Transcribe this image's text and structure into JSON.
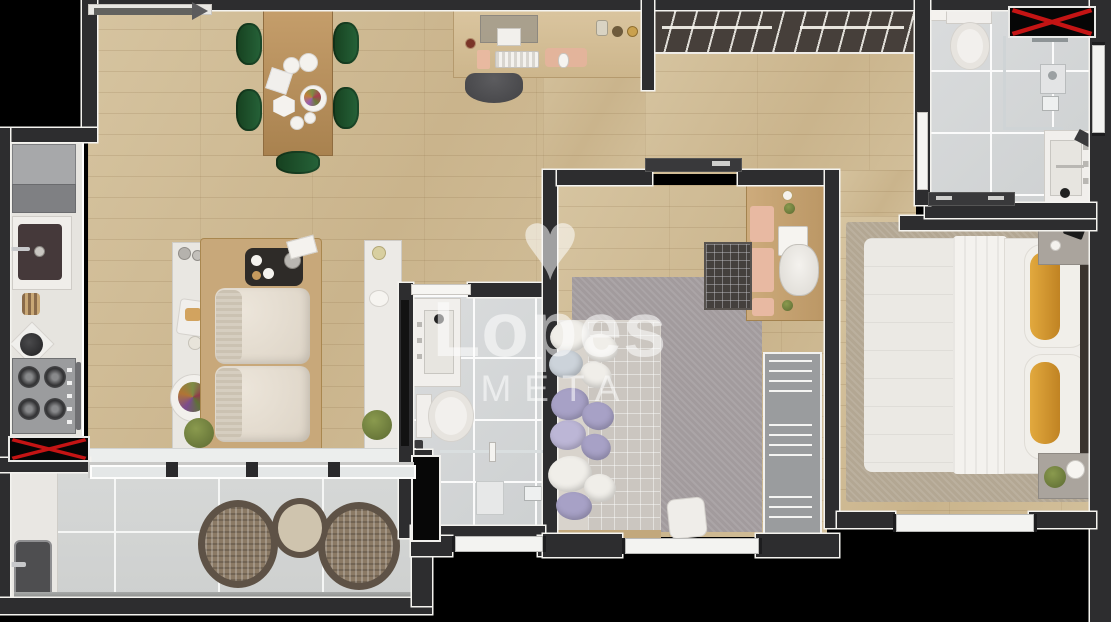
{
  "watermark": {
    "brand": "Lopes",
    "division": "META",
    "logo_glyph": "♥",
    "text_color": "#ffffff"
  },
  "palette": {
    "outside": "#000000",
    "wall": "#2d2d2f",
    "wall_trim": "#f4f3ef",
    "wood_floor": "#cfbb95",
    "bath_tile": "#d6d8d9",
    "balcony_tile": "#d2d4d3",
    "counter_white": "#e9e7e2",
    "rug_gray": "#a29b9d",
    "rug_beige": "#b3a793",
    "bedding": "#ebe9e4",
    "quilt": "#cbc6c0",
    "pillow_lavender": "#a7a1c6",
    "pillow_orange": "#d9952b",
    "dining_chair_green": "#1b4726",
    "furniture_wood": "#c29c6b",
    "closet": "#463f3a",
    "appliance_gray": "#9b9c9e",
    "shaft_black": "#060606",
    "cross_red": "#c41414",
    "plant_green": "#76853f"
  },
  "markers": {
    "crossed_shaft_count": 2
  },
  "rooms": {
    "living_dining": {
      "furniture": [
        "dining-table",
        "dining-chair x5",
        "sofa",
        "side-island",
        "serving-tray",
        "tv-console",
        "tv",
        "floor-plant"
      ]
    },
    "office_nook": {
      "furniture": [
        "desk",
        "monitor",
        "keyboard",
        "mouse-pad",
        "desk-chair"
      ]
    },
    "kitchen": {
      "furniture": [
        "fridge",
        "sink",
        "utensil-crock",
        "kettle",
        "gas-stove",
        "oven-handle"
      ]
    },
    "hall_closet": {
      "furniture": [
        "open-wardrobe-hanger-rail"
      ]
    },
    "bathroom_top_right": {
      "furniture": [
        "toilet",
        "shower-glass",
        "shower-column",
        "floor-drain",
        "vanity-sink",
        "sliding-door",
        "door-leaf",
        "window"
      ]
    },
    "bathroom_center": {
      "furniture": [
        "door-leaf",
        "vanity-sink",
        "toilet",
        "shaft",
        "shower-glass",
        "shower-shelf",
        "floor-drain",
        "window"
      ]
    },
    "bedroom_middle": {
      "furniture": [
        "sliding-door",
        "desk",
        "laptop",
        "desk-chair",
        "crib",
        "rug",
        "bed",
        "pillows",
        "ottoman",
        "wardrobe",
        "window"
      ]
    },
    "bedroom_master": {
      "furniture": [
        "rug",
        "double-bed",
        "orange-pillows",
        "headboard",
        "nightstand x2",
        "table-lamp",
        "plant",
        "window"
      ]
    },
    "balcony": {
      "furniture": [
        "sliding-glass-door",
        "counter-sink",
        "rattan-chair x2",
        "bistro-table",
        "glass-railing"
      ]
    }
  }
}
